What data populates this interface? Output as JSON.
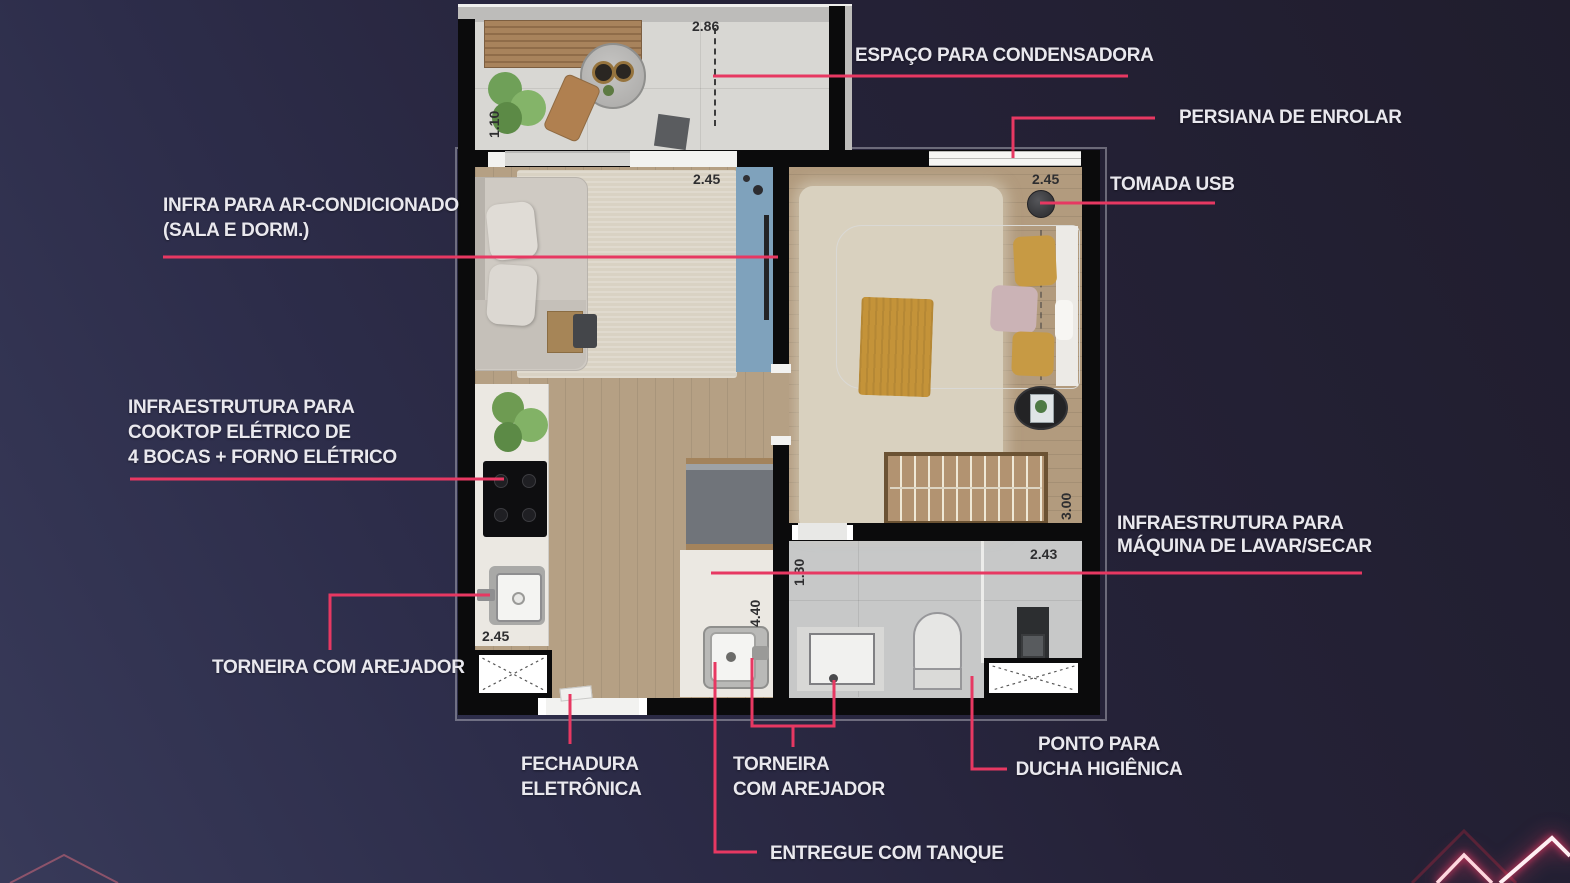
{
  "colors": {
    "accent": "#e73862",
    "label_text": "#e9e8ee",
    "wall": "#0b0b0c",
    "background_start": "#383a59",
    "background_end": "#201d2d",
    "accent_panel_blue": "#7fa2bc"
  },
  "annotations": {
    "condensadora": {
      "lines": [
        "ESPAÇO PARA CONDENSADORA"
      ]
    },
    "persiana": {
      "lines": [
        "PERSIANA DE ENROLAR"
      ]
    },
    "tomada_usb": {
      "lines": [
        "TOMADA USB"
      ]
    },
    "infra_ar": {
      "lines": [
        "INFRA PARA AR-CONDICIONADO",
        "(SALA E DORM.)"
      ]
    },
    "infra_cooktop": {
      "lines": [
        "INFRAESTRUTURA PARA",
        "COOKTOP ELÉTRICO DE",
        "4 BOCAS + FORNO ELÉTRICO"
      ]
    },
    "torneira_cozinha": {
      "lines": [
        "TORNEIRA COM AREJADOR"
      ]
    },
    "fechadura_eletronica": {
      "lines": [
        "FECHADURA",
        "ELETRÔNICA"
      ]
    },
    "torneira_banheiro": {
      "lines": [
        "TORNEIRA",
        "COM AREJADOR"
      ]
    },
    "entregue_tanque": {
      "lines": [
        "ENTREGUE COM TANQUE"
      ]
    },
    "ponto_ducha": {
      "lines": [
        "PONTO PARA",
        "DUCHA HIGIÊNICA"
      ]
    },
    "infra_maquina": {
      "lines": [
        "INFRAESTRUTURA PARA",
        "MÁQUINA DE LAVAR/SECAR"
      ]
    }
  },
  "dimensions": {
    "varanda_largura": "2.86",
    "varanda_profundidade": "1.10",
    "dorm1_largura": "2.45",
    "dorm2_largura": "2.45",
    "dorm2_profundidade": "3.00",
    "banheiro_profundidade": "1.30",
    "banheiro_largura": "2.43",
    "sala_profundidade": "4.40",
    "cozinha_largura": "2.45"
  }
}
